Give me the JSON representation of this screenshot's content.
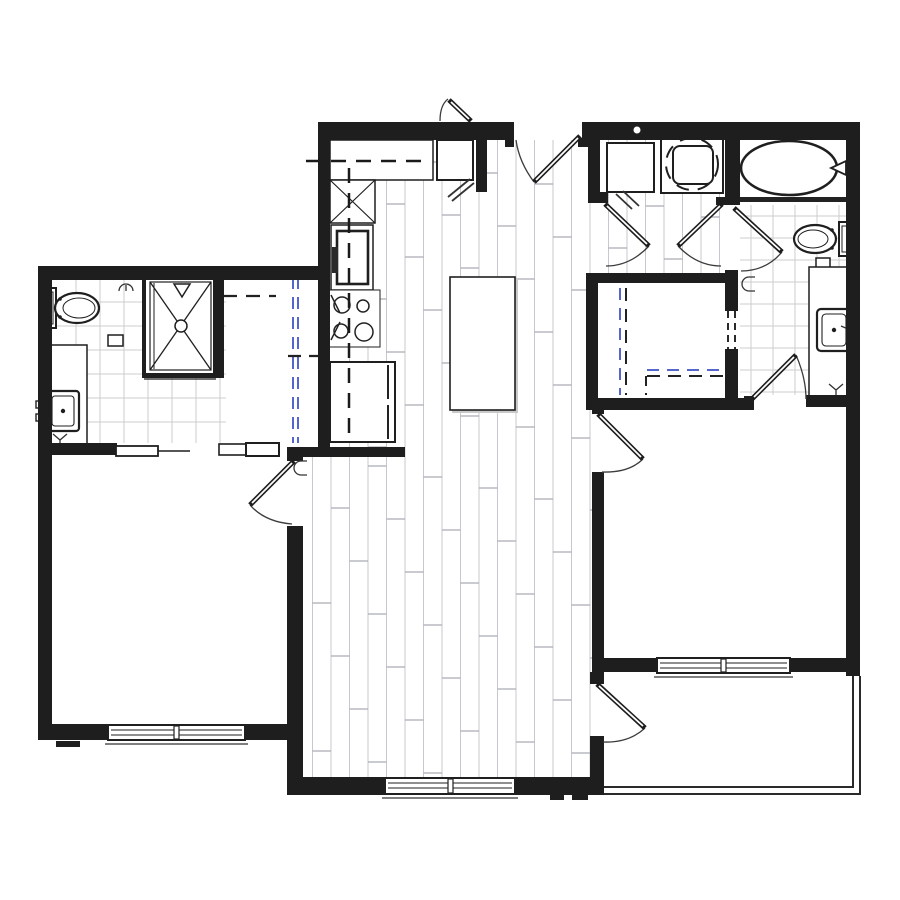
{
  "title": "Apartment floor plan (one-level unit, no text labels)",
  "colors": {
    "background": "#ffffff",
    "wall": "#1e1e1e",
    "line": "#2a2a2a",
    "thin_line": "#3c3c3c",
    "plank_line": "#c5c8ce",
    "plank_joint": "#a9acb4",
    "tile_line": "#cccccf",
    "closet_rod_blue": "#5566cc",
    "shadow_gray": "#c9c9c9"
  },
  "rooms": [
    {
      "name": "kitchen",
      "floor": "wood-plank",
      "fixtures": [
        "upper-cabinet-dashed-line",
        "counter",
        "corner-cabinet-x",
        "wall-oven",
        "cooktop-4-burner",
        "refrigerator",
        "island"
      ]
    },
    {
      "name": "living-dining",
      "floor": "wood-plank",
      "fixtures": []
    },
    {
      "name": "bathroom-left",
      "floor": "tile",
      "fixtures": [
        "toilet",
        "vanity-sink",
        "shower-with-x",
        "towel-hook",
        "paper-holder"
      ]
    },
    {
      "name": "closet-left",
      "floor": "plain",
      "fixtures": [
        "rod-dashed-blue",
        "shelf-dashed"
      ]
    },
    {
      "name": "bedroom-1",
      "floor": "plain",
      "fixtures": [
        "window-double"
      ]
    },
    {
      "name": "laundry-closet",
      "floor": "wood-plank",
      "fixtures": [
        "washer",
        "dryer-round-drum"
      ]
    },
    {
      "name": "bathroom-right",
      "floor": "tile",
      "fixtures": [
        "bathtub-oval",
        "toilet",
        "vanity-sink",
        "towel-hook",
        "paper-holder"
      ]
    },
    {
      "name": "walk-in-closet-right",
      "floor": "plain",
      "fixtures": [
        "rod-dashed-blue",
        "shelf-dashed"
      ]
    },
    {
      "name": "bedroom-2",
      "floor": "plain",
      "fixtures": [
        "window-double"
      ]
    },
    {
      "name": "balcony",
      "floor": "plain",
      "fixtures": [
        "railing-double-line"
      ]
    }
  ],
  "doors": [
    "entry-swing-door",
    "exterior-small-outswing-door",
    "laundry-double-doors",
    "bath-right-hall-door",
    "bath-right-bedroom-door",
    "closet-right-dashed-opening",
    "bedroom-2-door",
    "bedroom-1-door",
    "bathroom-left-pocket-door",
    "balcony-door"
  ],
  "windows": [
    "bedroom-1-window",
    "living-room-window",
    "bedroom-2-window"
  ],
  "symbols": [
    "peephole-circle-top-wall",
    "shower-head-triangle",
    "drain-circle",
    "door-hook-marks",
    "wall-tick-marks"
  ]
}
